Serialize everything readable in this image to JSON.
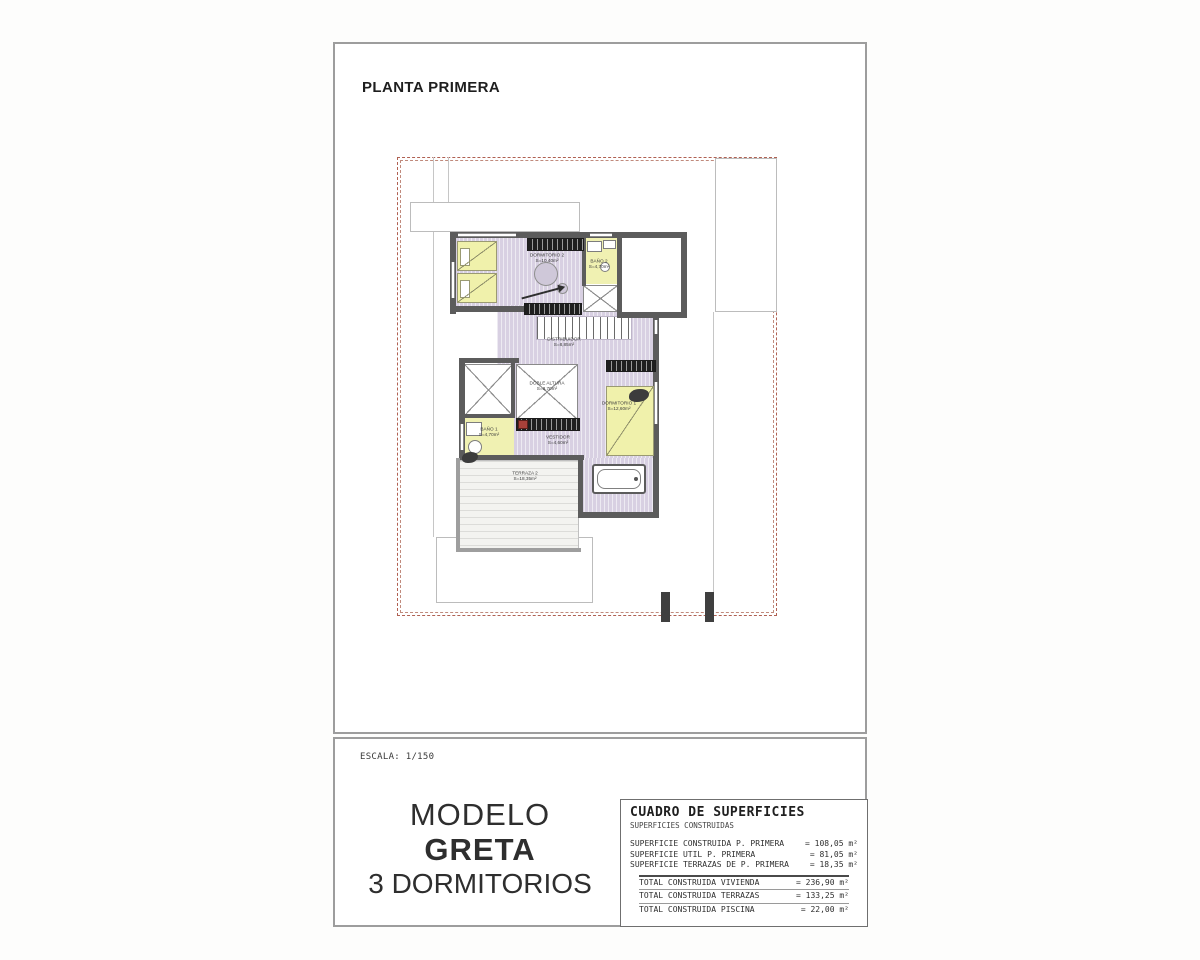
{
  "page": {
    "title": "PLANTA PRIMERA",
    "scale_label": "ESCALA: 1/150"
  },
  "model": {
    "line1": "MODELO",
    "line2": "GRETA",
    "line3": "3 DORMITORIOS"
  },
  "plan": {
    "rooms": [
      {
        "id": "dormitorio-2",
        "label": "DORMITORIO 2",
        "area": "S=10,40m²"
      },
      {
        "id": "bano-2",
        "label": "BAÑO 2",
        "area": "S=4,70m²"
      },
      {
        "id": "distribuidor",
        "label": "DISTRIBUIDOR",
        "area": "S=8,85m²"
      },
      {
        "id": "doble-altura",
        "label": "DOBLE ALTURA",
        "area": "S=8,70m²"
      },
      {
        "id": "bano-1",
        "label": "BAÑO 1",
        "area": "S=4,70m²"
      },
      {
        "id": "vestidor",
        "label": "VESTIDOR",
        "area": "S=4,60m²"
      },
      {
        "id": "dormitorio-1",
        "label": "DORMITORIO 1",
        "area": "S=12,60m²"
      },
      {
        "id": "terraza-2",
        "label": "TERRAZA 2",
        "area": "S=18,35m²"
      }
    ]
  },
  "surfaces_table": {
    "title": "CUADRO DE SUPERFICIES",
    "subtitle": "SUPERFICIES CONSTRUIDAS",
    "rows": [
      {
        "label": "SUPERFICIE CONSTRUIDA P. PRIMERA",
        "value": "= 108,05 m²"
      },
      {
        "label": "SUPERFICIE UTIL P. PRIMERA",
        "value": "= 81,05 m²"
      },
      {
        "label": "SUPERFICIE TERRAZAS DE P. PRIMERA",
        "value": "= 18,35 m²"
      }
    ],
    "totals": [
      {
        "label": "TOTAL CONSTRUIDA VIVIENDA",
        "value": "= 236,90 m²"
      },
      {
        "label": "TOTAL CONSTRUIDA TERRAZAS",
        "value": "= 133,25 m²"
      },
      {
        "label": "TOTAL CONSTRUIDA PISCINA",
        "value": "= 22,00 m²"
      }
    ]
  },
  "colors": {
    "wall": "#5c5c5c",
    "floor_interior": "#d8d0e2",
    "floor_wet_rooms": "#f0f1b2",
    "plot_boundary_dash": "#b06153",
    "sheet_border": "#9d9d9d"
  }
}
